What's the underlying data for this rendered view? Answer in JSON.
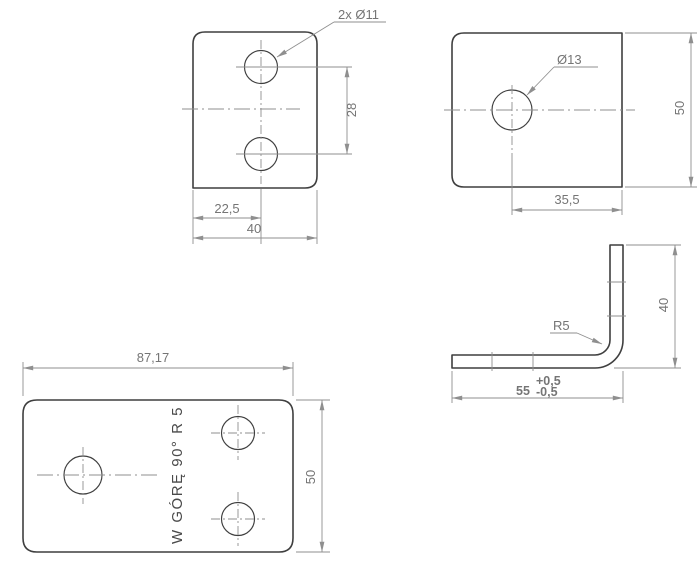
{
  "drawing": {
    "type": "technical-drawing",
    "subject": "sheet-metal L bracket, four views with dimensions",
    "views": {
      "front_view": {
        "hole_callout": "2x Ø11",
        "dim_hole_spacing": "28",
        "dim_hole_offset": "22,5",
        "dim_width": "40"
      },
      "top_view": {
        "hole_callout": "Ø13",
        "dim_height": "50",
        "dim_hole_offset": "35,5"
      },
      "side_view": {
        "radius_callout": "R5",
        "dim_leg_height": "40",
        "dim_base": "55",
        "tol_plus": "+0,5",
        "tol_minus": "-0,5"
      },
      "flat_pattern": {
        "dim_length": "87,17",
        "dim_width": "50",
        "bend_note": "W GÓRĘ 90° R 5"
      }
    },
    "colors": {
      "outline": "#3f3f3f",
      "thin_lines": "#8f8f8f",
      "dimension_text": "#757575",
      "note_text": "#4a4a4a",
      "background": "#ffffff"
    }
  }
}
